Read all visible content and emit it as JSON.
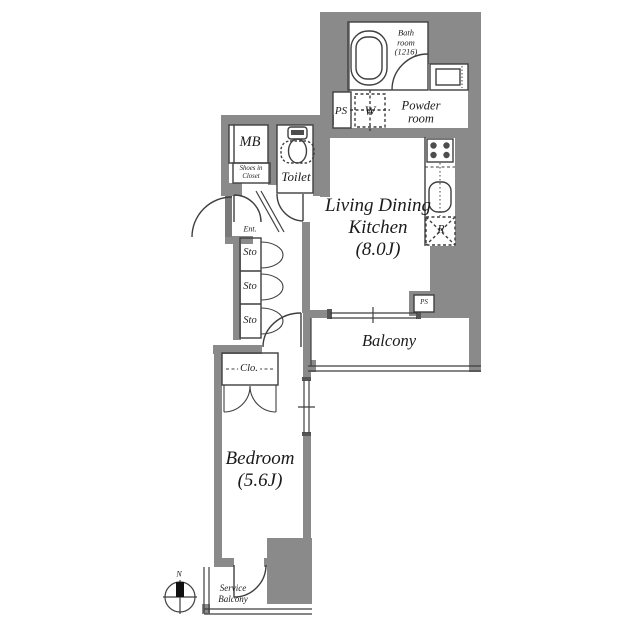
{
  "title": "Apartment floor plan 1K/1LDK",
  "colors": {
    "wall": "#8a8a8a",
    "line": "#3f3f3f",
    "text": "#1b1b1b",
    "fixture_dark": "#4d4d4d"
  },
  "labels": {
    "bath_room": "Bath\nroom\n(1216)",
    "ps_upper": "PS",
    "washer": "W",
    "powder_room": "Powder\nroom",
    "meter_box": "MB",
    "shoes_closet": "Shoes in\nCloset",
    "toilet": "Toilet",
    "ldk": "Living Dining\nKitchen\n(8.0J)",
    "fridge": "R",
    "entrance": "Ent.",
    "storage_1": "Sto",
    "storage_2": "Sto",
    "storage_3": "Sto",
    "balcony": "Balcony",
    "ps_lower": "PS",
    "closet": "Clo.",
    "bedroom": "Bedroom\n(5.6J)",
    "service_balcony": "Service\nBalcony",
    "compass_north": "N"
  },
  "icons": [
    "bathtub-icon",
    "washbasin-icon",
    "washer-icon",
    "toilet-icon",
    "stove-icon",
    "sink-icon",
    "fridge-icon",
    "door-arc-icon",
    "window-icon",
    "compass-icon"
  ]
}
